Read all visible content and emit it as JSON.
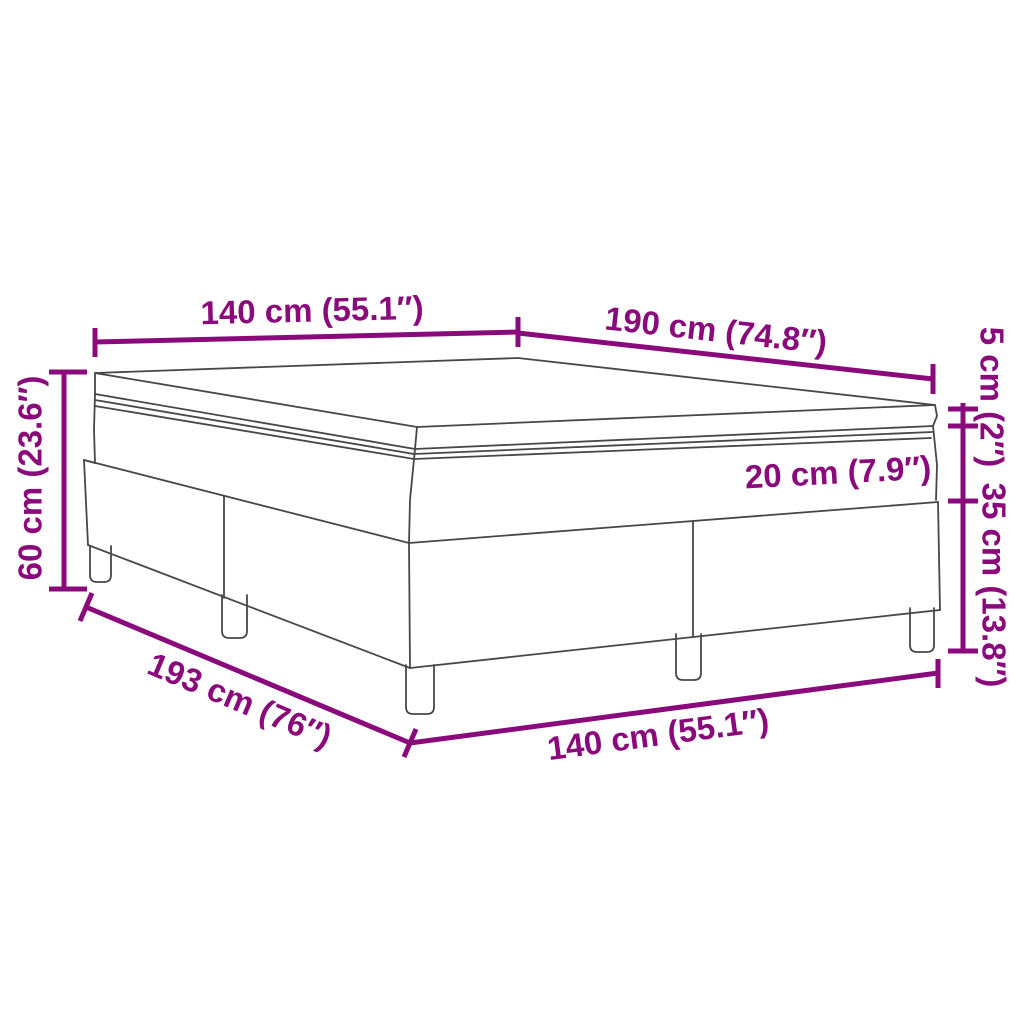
{
  "figure": {
    "kind": "product-dimension-diagram",
    "subject": "box spring bed with mattress and topper, corner perspective line drawing"
  },
  "colors": {
    "background": "#ffffff",
    "dimension": "#8A0A7B",
    "outline": "#474747",
    "leg_fill": "#ffffff"
  },
  "diagram": {
    "canvas": [
      1024,
      1024
    ],
    "dimension_style": {
      "line_width": 5,
      "tick_width": 5,
      "font_size": 33
    },
    "dimensions": [
      {
        "name": "top-width",
        "line": [
          [
            95,
            342
          ],
          [
            518,
            332
          ]
        ],
        "ticks": [
          [
            [
              95,
              328
            ],
            [
              95,
              357
            ]
          ],
          [
            [
              518,
              317
            ],
            [
              518,
              347
            ]
          ]
        ],
        "labels": [
          {
            "text": "140 cm (55.1″)",
            "x": 312,
            "y": 310,
            "rot": -1.4
          }
        ]
      },
      {
        "name": "top-length",
        "line": [
          [
            518,
            333
          ],
          [
            933,
            379
          ]
        ],
        "ticks": [
          [
            [
              933,
              364
            ],
            [
              933,
              394
            ]
          ]
        ],
        "labels": [
          {
            "text": "190 cm (74.8″)",
            "x": 716,
            "y": 330,
            "rot": 6.3
          }
        ]
      },
      {
        "name": "right-height-scale",
        "line": [
          [
            963,
            403
          ],
          [
            963,
            651
          ]
        ],
        "ticks": [
          [
            [
              948,
              409
            ],
            [
              978,
              409
            ]
          ],
          [
            [
              948,
              426
            ],
            [
              978,
              426
            ]
          ],
          [
            [
              948,
              501
            ],
            [
              978,
              501
            ]
          ],
          [
            [
              948,
              651
            ],
            [
              978,
              651
            ]
          ]
        ],
        "labels": [
          {
            "text": "5 cm (2″)",
            "x": 992,
            "y": 397,
            "rot": 90
          },
          {
            "text": "35 cm (13.8″)",
            "x": 994,
            "y": 585,
            "rot": 90
          },
          {
            "text": "20 cm (7.9″)",
            "x": 838,
            "y": 472,
            "rot": -3
          }
        ]
      },
      {
        "name": "left-total-height",
        "line": [
          [
            64,
            372
          ],
          [
            64,
            589
          ]
        ],
        "ticks": [
          [
            [
              49,
              372
            ],
            [
              87,
              372
            ]
          ],
          [
            [
              49,
              589
            ],
            [
              87,
              589
            ]
          ]
        ],
        "labels": [
          {
            "text": "60 cm (23.6″)",
            "x": 30,
            "y": 478,
            "rot": -90
          }
        ]
      },
      {
        "name": "bottom-base-length",
        "line": [
          [
            86,
            607
          ],
          [
            410,
            743
          ]
        ],
        "ticks": [
          [
            [
              92,
              593
            ],
            [
              80,
              621
            ]
          ],
          [
            [
              416,
              729
            ],
            [
              404,
              757
            ]
          ]
        ],
        "labels": [
          {
            "text": "193 cm (76″)",
            "x": 240,
            "y": 700,
            "rot": 22.8
          }
        ]
      },
      {
        "name": "bottom-base-width",
        "line": [
          [
            410,
            743
          ],
          [
            938,
            673
          ]
        ],
        "ticks": [
          [
            [
              938,
              659
            ],
            [
              938,
              688
            ]
          ]
        ],
        "labels": [
          {
            "text": "140 cm (55.1″)",
            "x": 658,
            "y": 734,
            "rot": -7.6
          }
        ]
      }
    ],
    "bed": {
      "outline_width": 1.8,
      "polylines": [
        {
          "name": "topper-top-face",
          "points": [
            [
              95,
              373
            ],
            [
              518,
              358
            ],
            [
              935,
              405
            ],
            [
              417,
              427
            ],
            [
              95,
              373
            ]
          ]
        },
        {
          "name": "topper-front-bottom-edge",
          "points": [
            [
              95,
              394
            ],
            [
              415,
              449
            ],
            [
              933,
              426
            ]
          ]
        },
        {
          "name": "topper-left-edge",
          "points": [
            [
              95,
              373
            ],
            [
              95,
              394
            ]
          ]
        },
        {
          "name": "topper-near-corner-edge",
          "points": [
            [
              417,
              427
            ],
            [
              415,
              449
            ]
          ]
        },
        {
          "name": "topper-right-tip-edge",
          "points": [
            [
              935,
              405
            ],
            [
              937,
              416
            ],
            [
              933,
              426
            ]
          ]
        },
        {
          "name": "mattress-piping-upper",
          "points": [
            [
              95,
              400
            ],
            [
              414,
              454
            ],
            [
              932,
              432
            ]
          ]
        },
        {
          "name": "mattress-piping-lower",
          "points": [
            [
              95,
              406
            ],
            [
              414,
              459
            ],
            [
              931,
              438
            ]
          ]
        },
        {
          "name": "mattress-left-edge",
          "points": [
            [
              95,
              394
            ],
            [
              94,
              430
            ],
            [
              95,
              463
            ]
          ]
        },
        {
          "name": "mattress-near-corner-edge",
          "points": [
            [
              415,
              449
            ],
            [
              410,
              500
            ],
            [
              409,
              543
            ]
          ]
        },
        {
          "name": "mattress-right-edge",
          "points": [
            [
              933,
              426
            ],
            [
              937,
              465
            ],
            [
              936,
              500
            ]
          ]
        },
        {
          "name": "boxspring-top-left-sliver",
          "points": [
            [
              84,
              460
            ],
            [
              95,
              463
            ]
          ]
        },
        {
          "name": "boxspring-top-edge-left",
          "points": [
            [
              84,
              460
            ],
            [
              409,
              543
            ]
          ]
        },
        {
          "name": "boxspring-top-edge-right",
          "points": [
            [
              409,
              543
            ],
            [
              938,
              502
            ]
          ]
        },
        {
          "name": "boxspring-left-corner-edge",
          "points": [
            [
              84,
              460
            ],
            [
              88,
              545
            ]
          ]
        },
        {
          "name": "boxspring-near-corner-edge",
          "points": [
            [
              409,
              543
            ],
            [
              410,
              668
            ]
          ]
        },
        {
          "name": "boxspring-right-corner-edge",
          "points": [
            [
              938,
              502
            ],
            [
              940,
              610
            ]
          ]
        },
        {
          "name": "boxspring-bottom-edge-left",
          "points": [
            [
              88,
              545
            ],
            [
              410,
              668
            ]
          ]
        },
        {
          "name": "boxspring-bottom-edge-right",
          "points": [
            [
              410,
              668
            ],
            [
              940,
              610
            ]
          ]
        },
        {
          "name": "boxspring-seam-left",
          "points": [
            [
              224,
              496
            ],
            [
              224,
              598
            ]
          ]
        },
        {
          "name": "boxspring-seam-right",
          "points": [
            [
              693,
              521
            ],
            [
              693,
              637
            ]
          ]
        }
      ],
      "legs": [
        {
          "x1": 90,
          "x2": 111,
          "y1": 549,
          "y2": 582
        },
        {
          "x1": 222,
          "x2": 247,
          "y1": 598,
          "y2": 638
        },
        {
          "x1": 406,
          "x2": 434,
          "y1": 668,
          "y2": 714
        },
        {
          "x1": 676,
          "x2": 701,
          "y1": 637,
          "y2": 680
        },
        {
          "x1": 910,
          "x2": 934,
          "y1": 611,
          "y2": 652
        }
      ]
    }
  }
}
